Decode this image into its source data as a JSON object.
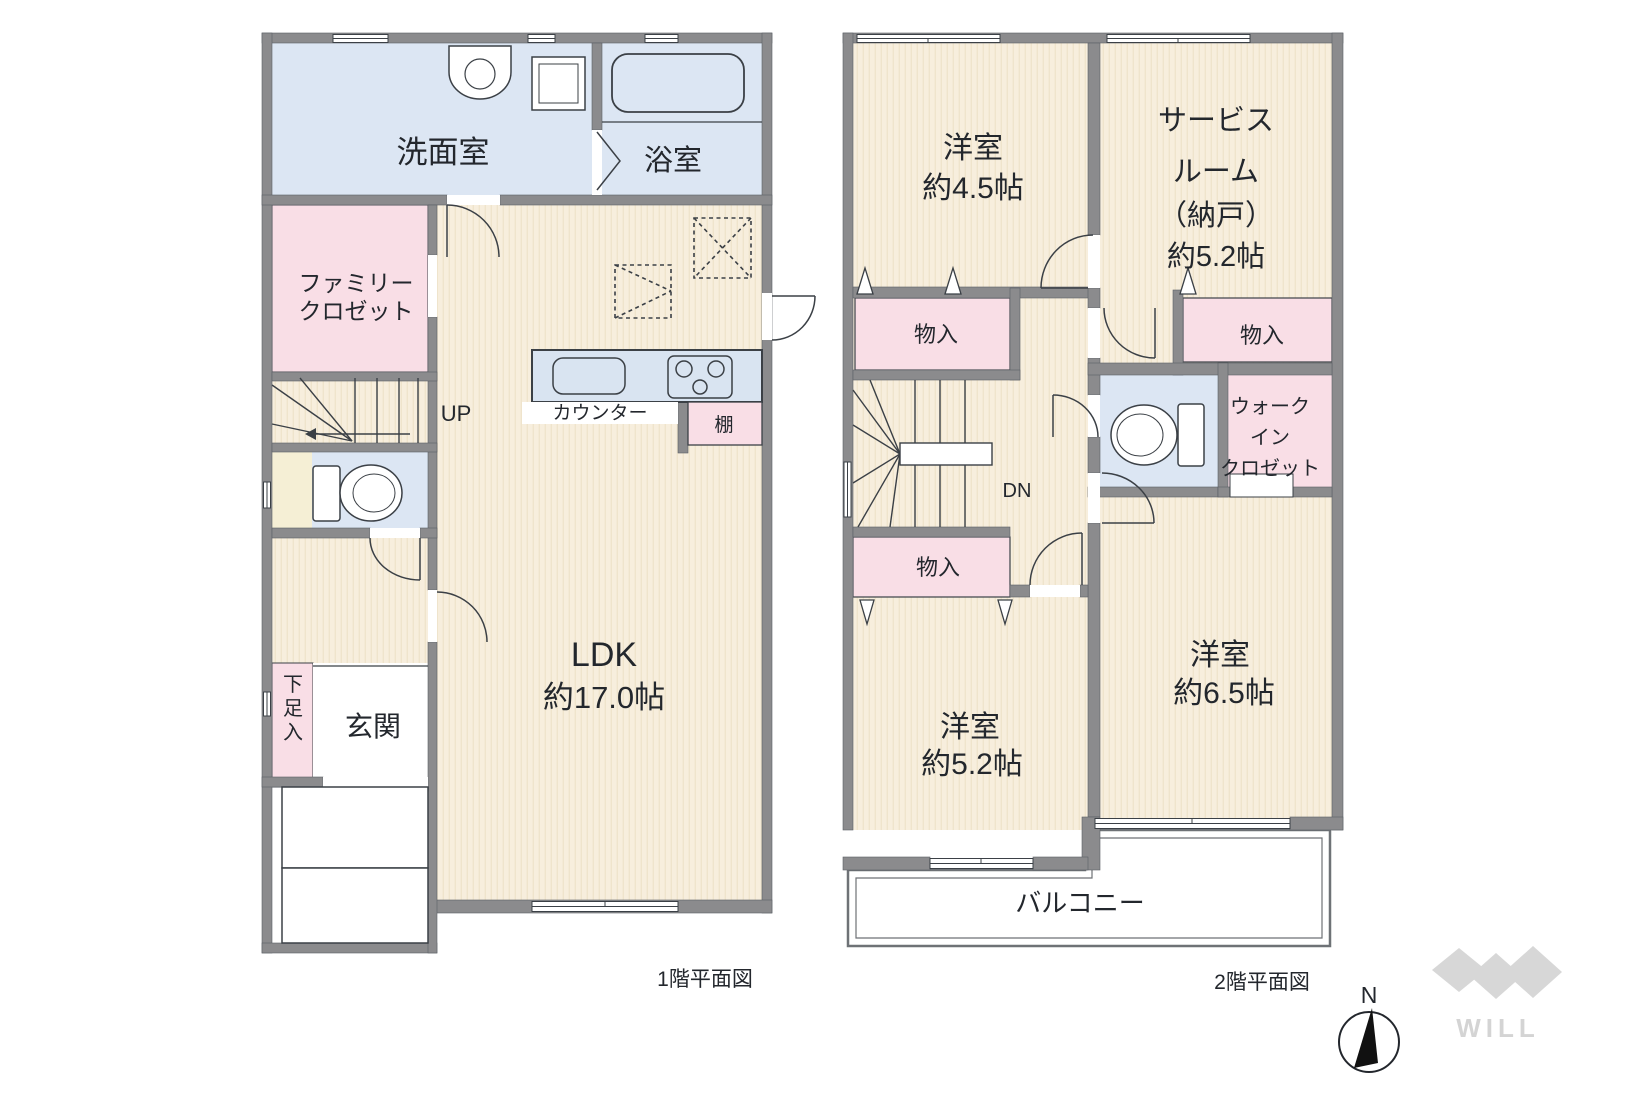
{
  "colors": {
    "wall_gray": "#8b8b8d",
    "outline_dark": "#3b4046",
    "room_beige": "#f7eedd",
    "wet_area_blue": "#dce6f3",
    "closet_pink": "#f9dee6",
    "cream": "#f5efd5",
    "counter_blue": "#d9e4f1",
    "text": "#23272d",
    "logo_gray": "#d7d7d7"
  },
  "floor1": {
    "caption": "1階平面図",
    "stairs_label": "UP",
    "rooms": {
      "washroom": "洗面室",
      "bathroom": "浴室",
      "family_closet": [
        "ファミリー",
        "クロゼット"
      ],
      "ldk": [
        "LDK",
        "約17.0帖"
      ],
      "entrance": "玄関",
      "shoe_storage": [
        "下",
        "足",
        "入"
      ],
      "counter": "カウンター",
      "shelf": "棚"
    }
  },
  "floor2": {
    "caption": "2階平面図",
    "stairs_label": "DN",
    "rooms": {
      "bedroom_45": [
        "洋室",
        "約4.5帖"
      ],
      "service_room": [
        "サービス",
        "ルーム",
        "（納戸）",
        "約5.2帖"
      ],
      "storage_a": "物入",
      "storage_b": "物入",
      "storage_c": "物入",
      "walk_in_closet": [
        "ウォーク",
        "イン",
        "クロゼット"
      ],
      "bedroom_52": [
        "洋室",
        "約5.2帖"
      ],
      "bedroom_65": [
        "洋室",
        "約6.5帖"
      ],
      "balcony": "バルコニー"
    }
  },
  "compass": {
    "north": "N"
  },
  "logo": {
    "text": "WILL"
  }
}
